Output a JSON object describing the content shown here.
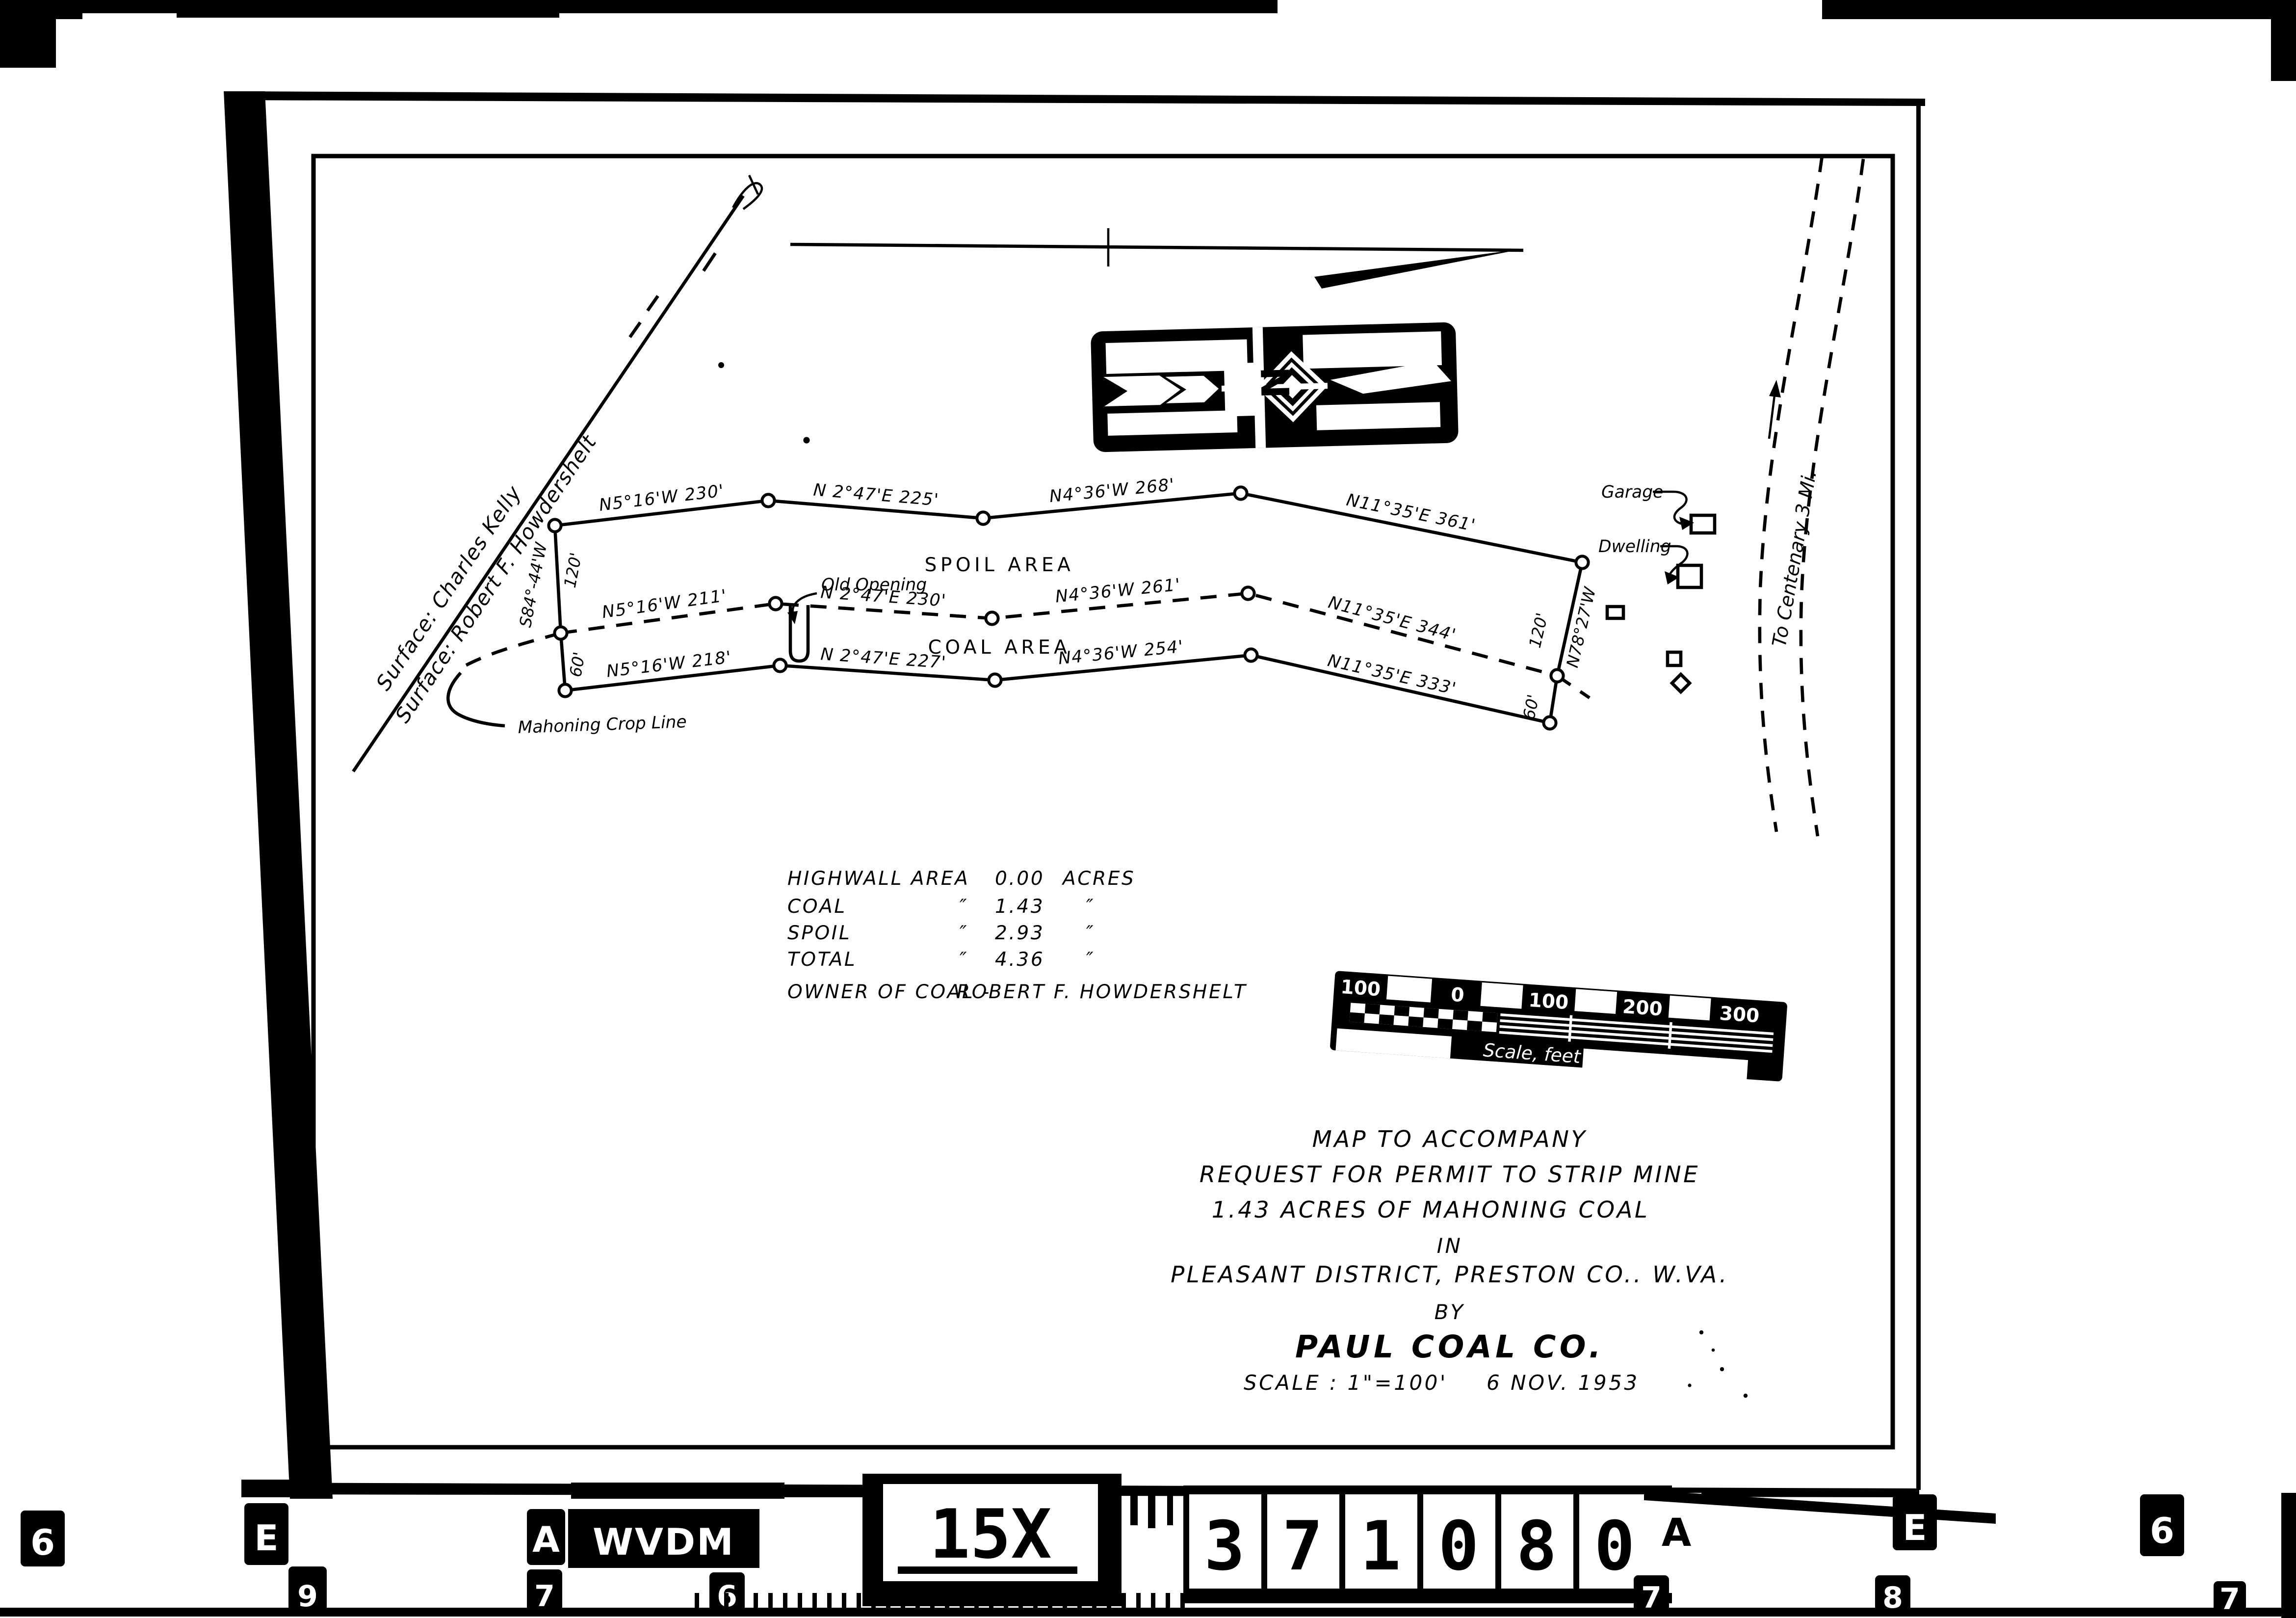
{
  "colors": {
    "ink": "#000000",
    "paper": "#ffffff"
  },
  "map": {
    "surface_labels": [
      "Surface:  Charles Kelly",
      "Surface:  Robert F. Howdershelt"
    ],
    "north_label": "N",
    "spoil_area_label": "SPOIL AREA",
    "coal_area_label": "COAL AREA",
    "old_opening_label": "Old Opening",
    "crop_line_label": "Mahoning Crop Line",
    "garage_label": "Garage",
    "dwelling_label": "Dwelling",
    "road_label": "To Centenary  3 Mi.",
    "bearings": {
      "top": [
        "N5°16'W  230'",
        "N 2°47'E  225'",
        "N4°36'W  268'",
        "N11°35'E  361'"
      ],
      "middle": [
        "N5°16'W  211'",
        "N 2°47'E  230'",
        "N4°36'W  261'",
        "N11°35'E  344'"
      ],
      "bottom": [
        "N5°16'W  218'",
        "N 2°47'E  227'",
        "N4°36'W  254'",
        "N11°35'E  333'"
      ]
    },
    "left_end": {
      "bearing": "S84°-44'W",
      "upper": "120'",
      "lower": "60'"
    },
    "right_end": {
      "bearing": "N78°27'W",
      "upper": "120'",
      "lower": "60'"
    }
  },
  "table": {
    "rows": [
      {
        "label": "HIGHWALL AREA",
        "value": "0.00",
        "unit": "ACRES"
      },
      {
        "label": "COAL",
        "d1": "″",
        "value": "1.43",
        "d2": "″"
      },
      {
        "label": "SPOIL",
        "d1": "″",
        "value": "2.93",
        "d2": "″"
      },
      {
        "label": "TOTAL",
        "d1": "″",
        "value": "4.36",
        "d2": "″"
      }
    ],
    "owner_label": "OWNER OF COAL -",
    "owner_value": "ROBERT F. HOWDERSHELT"
  },
  "scale_bar": {
    "ticks": [
      "100",
      "0",
      "100",
      "200",
      "300"
    ],
    "caption": "Scale, feet"
  },
  "title_block": {
    "line1": "MAP TO ACCOMPANY",
    "line2": "REQUEST FOR PERMIT TO STRIP MINE",
    "line3": "1.43 ACRES OF MAHONING COAL",
    "line4": "IN",
    "line5": "PLEASANT DISTRICT,  PRESTON CO.. W.VA.",
    "line6": "BY",
    "line7": "PAUL COAL CO.",
    "scale": "SCALE : 1\"=100'",
    "date": "6 NOV. 1953"
  },
  "film_strip": {
    "code": "WVDM",
    "magnification": "15X",
    "serial_digits": [
      "3",
      "7",
      "1",
      "0",
      "8",
      "0"
    ],
    "edge_marks_upper": [
      "6",
      "E",
      "A",
      "A",
      "E",
      "6"
    ],
    "edge_marks_lower": [
      "9",
      "7",
      "6",
      "7",
      "8",
      "7"
    ]
  }
}
